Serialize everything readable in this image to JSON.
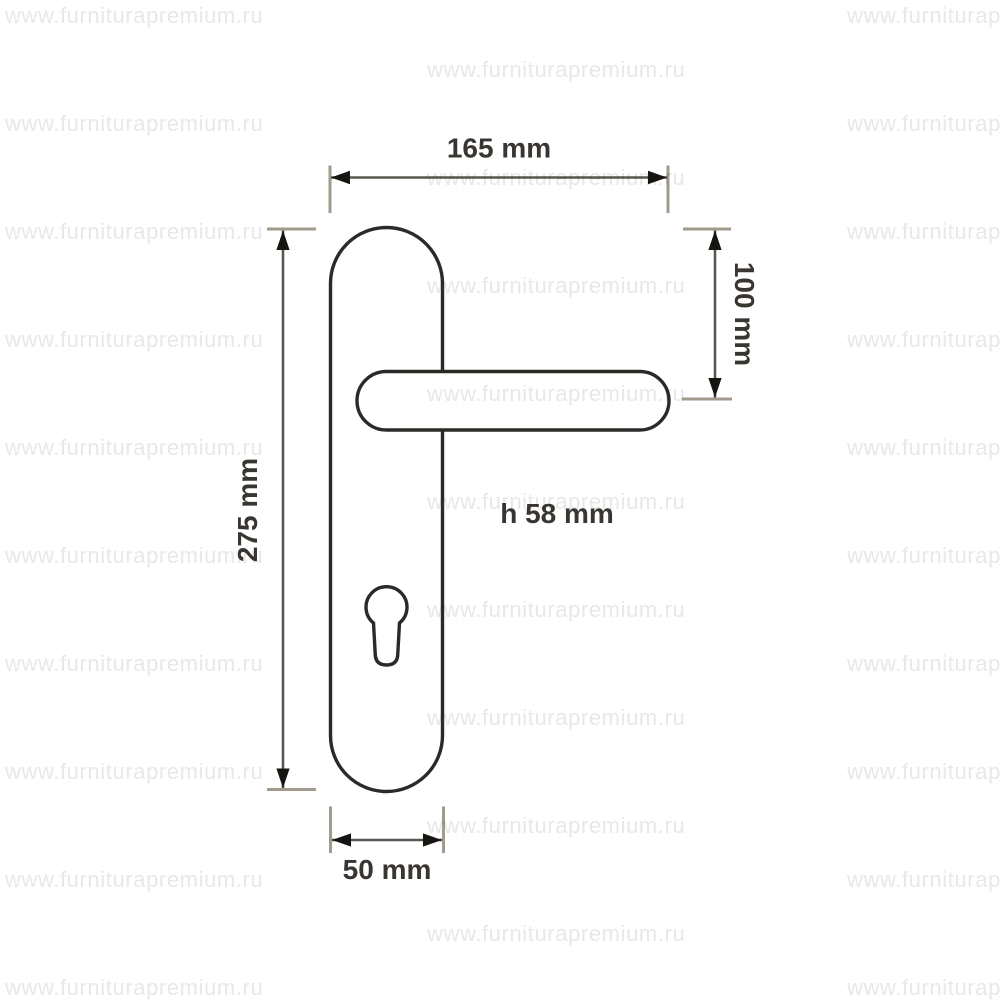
{
  "watermark": {
    "text": "www.furniturapremium.ru",
    "color": "#e8e8e8"
  },
  "drawing": {
    "labels": {
      "overall_width": "165 mm",
      "plate_height": "275 mm",
      "plate_top_to_handle": "100 mm",
      "plate_width": "50 mm",
      "handle_height": "h 58 mm"
    },
    "colors": {
      "outline": "#2c2a27",
      "dimension_line": "#5c574e",
      "extension_line": "#a29a8c",
      "arrow": "#171512",
      "label_text": "#393531"
    }
  }
}
